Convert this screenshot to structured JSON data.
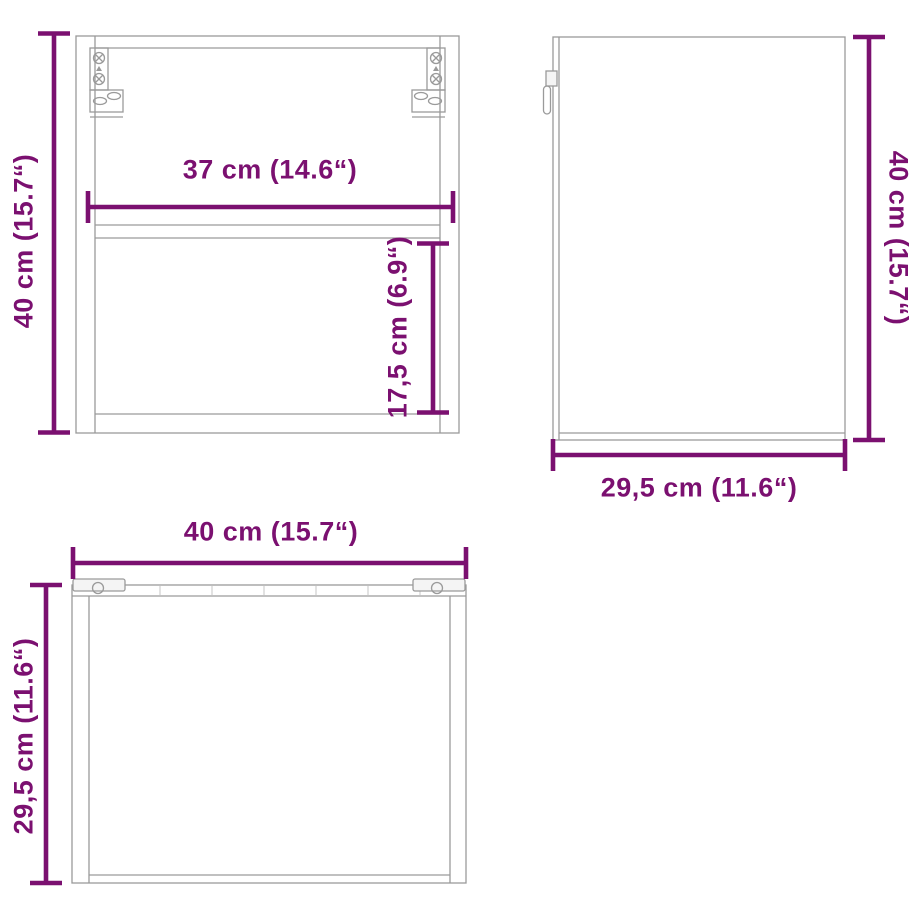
{
  "colors": {
    "accent": "#7B1070",
    "line": "#9A9A9A",
    "background": "#FFFFFF"
  },
  "diagram": {
    "type": "furniture-dimension-diagram",
    "product": "wall-mounted cabinet",
    "views": {
      "front": {
        "name": "front view",
        "dimensions": {
          "height": "40 cm (15.7“)",
          "inner_width": "37 cm (14.6“)",
          "lower_compartment_height": "17,5 cm (6.9“)"
        }
      },
      "side": {
        "name": "side view",
        "dimensions": {
          "height": "40 cm (15.7“)",
          "depth": "29,5 cm (11.6“)"
        }
      },
      "top": {
        "name": "top view",
        "dimensions": {
          "width": "40 cm (15.7“)",
          "depth": "29,5 cm (11.6“)"
        }
      }
    }
  }
}
